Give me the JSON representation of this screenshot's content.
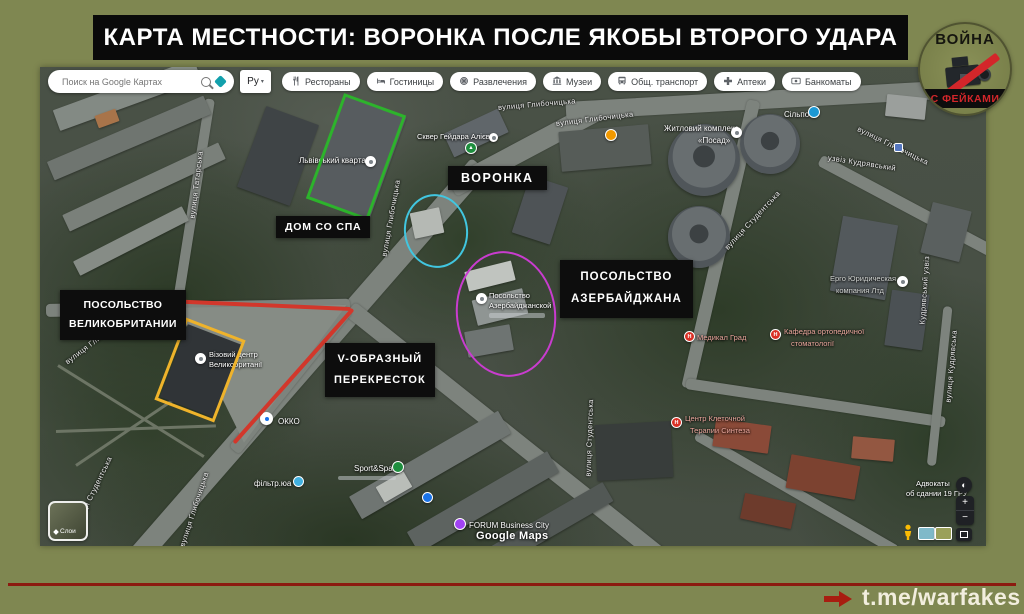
{
  "header": {
    "title": "КАРТА МЕСТНОСТИ: ВОРОНКА ПОСЛЕ ЯКОБЫ ВТОРОГО УДАРА"
  },
  "logo": {
    "top": "ВОЙНА",
    "bottom": "С ФЕЙКАМИ"
  },
  "footer": {
    "link": "t.me/warfakes"
  },
  "colors": {
    "page_bg": "#7f8751",
    "annotation_green": "#2db32c",
    "annotation_cyan": "#41c6e0",
    "annotation_magenta": "#c93ccf",
    "annotation_yellow": "#efb32b",
    "annotation_red": "#d2372b",
    "label_bg": "#0d0d0d",
    "logo_red": "#d3262a",
    "footer_line": "#8c1a10"
  },
  "maps_ui": {
    "search_placeholder": "Поиск на Google Картах",
    "lang_button": "Ру",
    "chips": [
      {
        "label": "Рестораны",
        "icon": "restaurant-icon"
      },
      {
        "label": "Гостиницы",
        "icon": "hotel-icon"
      },
      {
        "label": "Развлечения",
        "icon": "entertainment-icon"
      },
      {
        "label": "Музеи",
        "icon": "museum-icon"
      },
      {
        "label": "Общ. транспорт",
        "icon": "transit-icon"
      },
      {
        "label": "Аптеки",
        "icon": "pharmacy-icon"
      },
      {
        "label": "Банкоматы",
        "icon": "atm-icon"
      }
    ],
    "layers_label": "Слои",
    "zoom_in": "+",
    "zoom_out": "−",
    "watermark": "Google Maps"
  },
  "annotations": {
    "labels": [
      {
        "lines": [
          "ДОМ СО СПА"
        ]
      },
      {
        "lines": [
          "ВОРОНКА"
        ]
      },
      {
        "lines": [
          "ПОСОЛЬСТВО",
          "АЗЕРБАЙДЖАНА"
        ]
      },
      {
        "lines": [
          "ПОСОЛЬСТВО",
          "ВЕЛИКОБРИТАНИИ"
        ]
      },
      {
        "lines": [
          "V-ОБРАЗНЫЙ",
          "ПЕРЕКРЕСТОК"
        ]
      }
    ]
  },
  "streets": [
    "вулиця Глибочицька",
    "вулиця Глибочицька",
    "вулиця Глибочицька",
    "вулиця Татарська",
    "вулиця Глибочицька",
    "вулиця Глибочицька",
    "вулиця Студентська",
    "узвіз Кудрявський",
    "Кудрявський узвіз",
    "вулиця Студентська",
    "вулиця Студентська",
    "вулиця Глибочицька",
    "вулиця Кудрявська"
  ],
  "pois": {
    "lvivskyi": "Львівський квартал",
    "skver": "Сквер Гейдара Алієва",
    "silpo": "Сільпо",
    "posad": [
      "Житловий комплекс",
      "«Посад»"
    ],
    "ergo": [
      "Ерго Юридическая",
      "компания Лтд"
    ],
    "medical_grad": "Медикал Град",
    "kafedra": [
      "Кафедра ортопедичної",
      "стоматології"
    ],
    "centr": [
      "Центр Клеточной",
      "Терапии Синтеза"
    ],
    "embassy_az": [
      "Посольство",
      "Азербайджанской"
    ],
    "visa_uk": [
      "Візовий центр",
      "Великобританії"
    ],
    "okko": "ОККО",
    "sport": "Sport&Spa",
    "forum": "FORUM Business City",
    "advokaty": [
      "Адвокаты",
      "об сдании 19 ГРУ"
    ],
    "filtr": "фільтр.юа"
  },
  "icons": {
    "hospital": "H",
    "tree": "▲",
    "dropdown": "▾",
    "compass": "◐"
  }
}
